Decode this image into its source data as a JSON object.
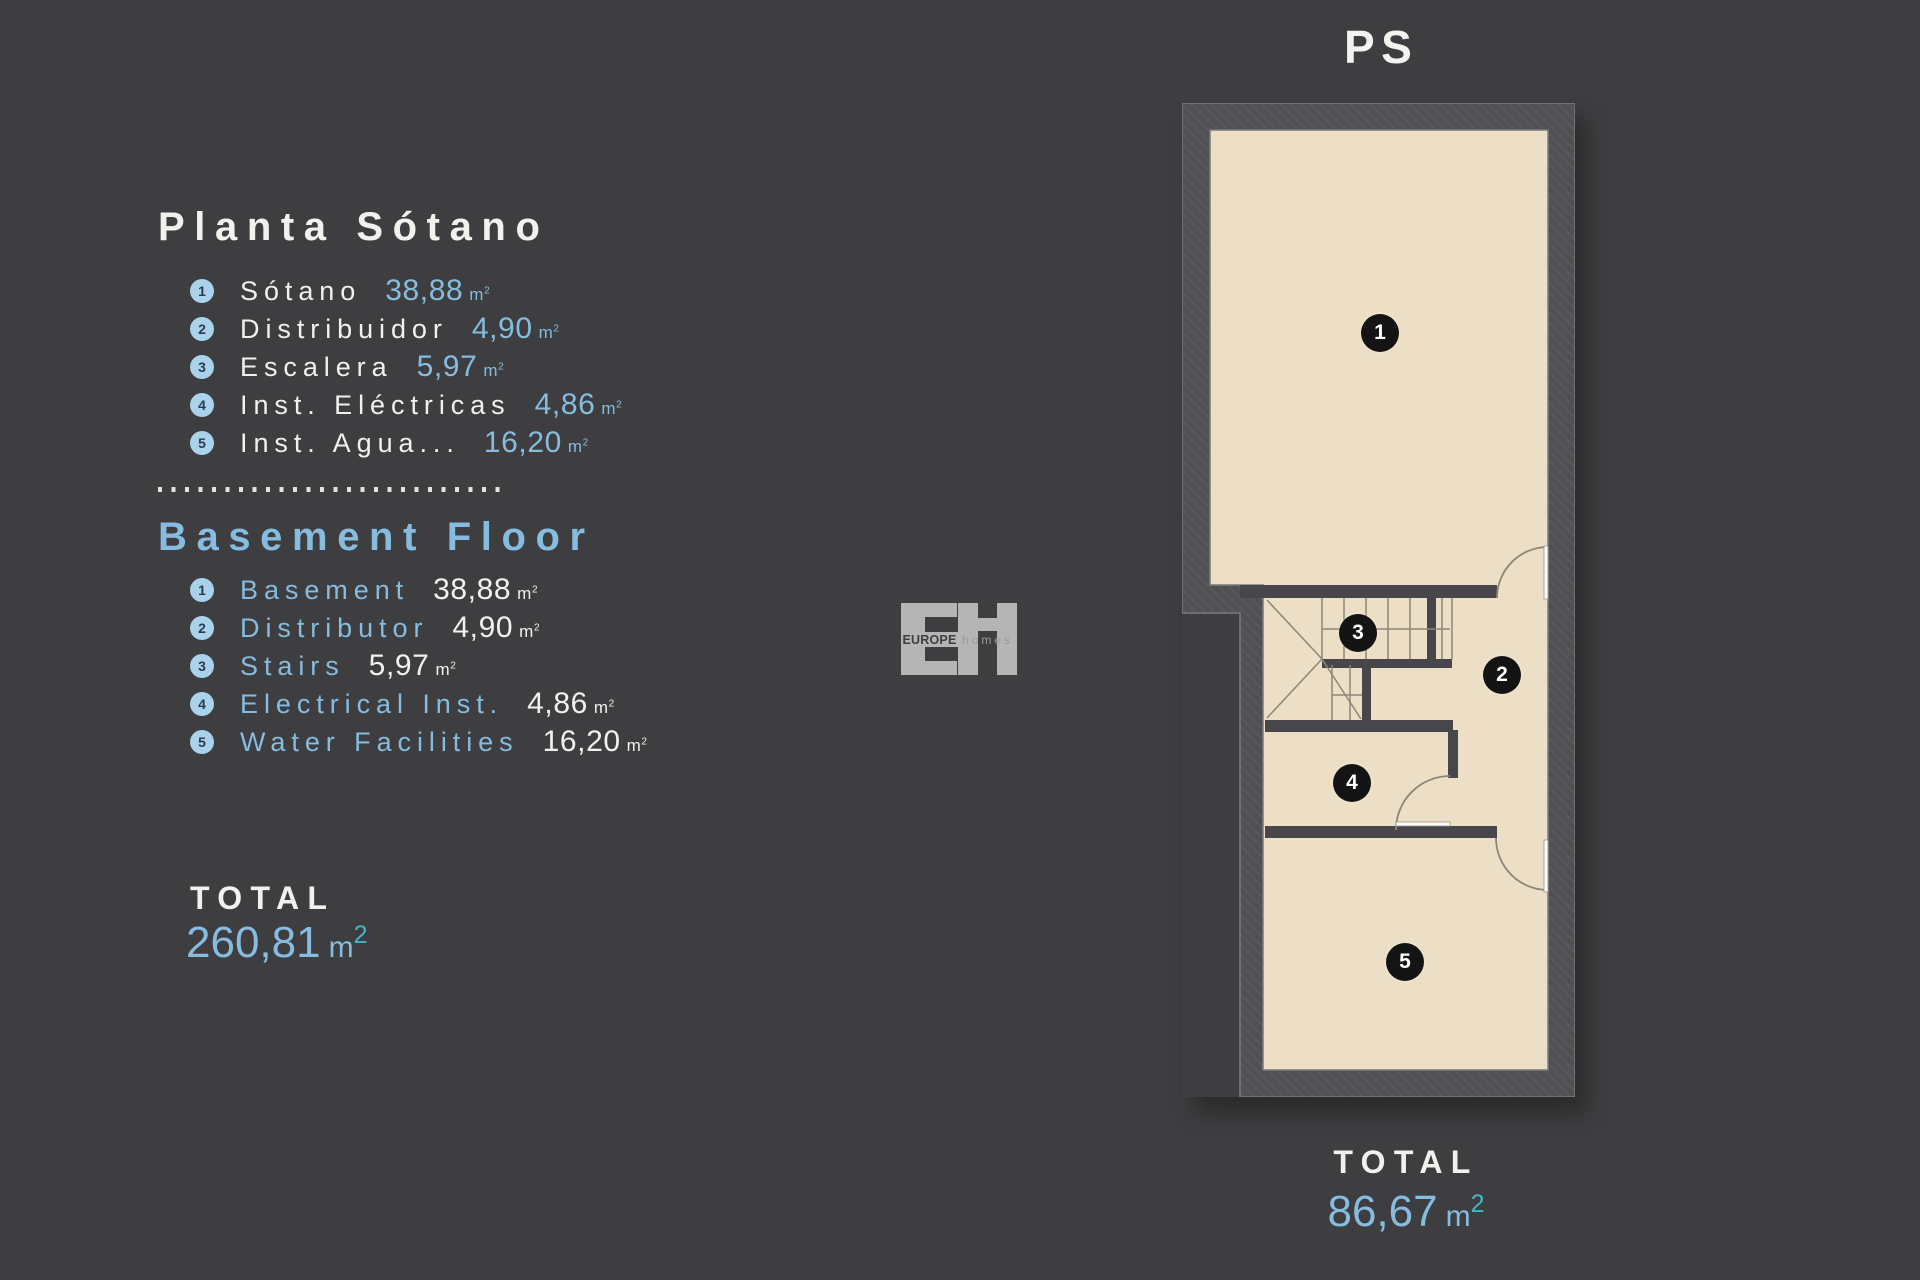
{
  "left": {
    "es": {
      "title": "Planta Sótano",
      "items": [
        {
          "num": "1",
          "label": "Sótano",
          "value": "38,88",
          "unit": "m",
          "sup": "2"
        },
        {
          "num": "2",
          "label": "Distribuidor",
          "value": "4,90",
          "unit": "m",
          "sup": "2"
        },
        {
          "num": "3",
          "label": "Escalera",
          "value": "5,97",
          "unit": "m",
          "sup": "2"
        },
        {
          "num": "4",
          "label": "Inst. Eléctricas",
          "value": "4,86",
          "unit": "m",
          "sup": "2"
        },
        {
          "num": "5",
          "label": "Inst. Agua...",
          "value": "16,20",
          "unit": "m",
          "sup": "2"
        }
      ]
    },
    "en": {
      "title": "Basement Floor",
      "items": [
        {
          "num": "1",
          "label": "Basement",
          "value": "38,88",
          "unit": "m",
          "sup": "2"
        },
        {
          "num": "2",
          "label": "Distributor",
          "value": "4,90",
          "unit": "m",
          "sup": "2"
        },
        {
          "num": "3",
          "label": "Stairs",
          "value": "5,97",
          "unit": "m",
          "sup": "2"
        },
        {
          "num": "4",
          "label": "Electrical Inst.",
          "value": "4,86",
          "unit": "m",
          "sup": "2"
        },
        {
          "num": "5",
          "label": "Water Facilities",
          "value": "16,20",
          "unit": "m",
          "sup": "2"
        }
      ]
    },
    "total": {
      "label": "TOTAL",
      "value": "260,81",
      "unit": "m",
      "sup": "2"
    }
  },
  "logo": {
    "europe": "EUROPE",
    "homes": "homes"
  },
  "plan": {
    "title": "PS",
    "badges": [
      {
        "num": "1"
      },
      {
        "num": "2"
      },
      {
        "num": "3"
      },
      {
        "num": "4"
      },
      {
        "num": "5"
      }
    ],
    "total": {
      "label": "TOTAL",
      "value": "86,67",
      "unit": "m",
      "sup": "2"
    }
  },
  "colors": {
    "background": "#3e3e40",
    "accent_blue": "#85bcdf",
    "teal_superscript": "#3fb9c8",
    "floor": "#ecdfc5",
    "wall": "#515154",
    "text_white": "#f2f1ee"
  }
}
